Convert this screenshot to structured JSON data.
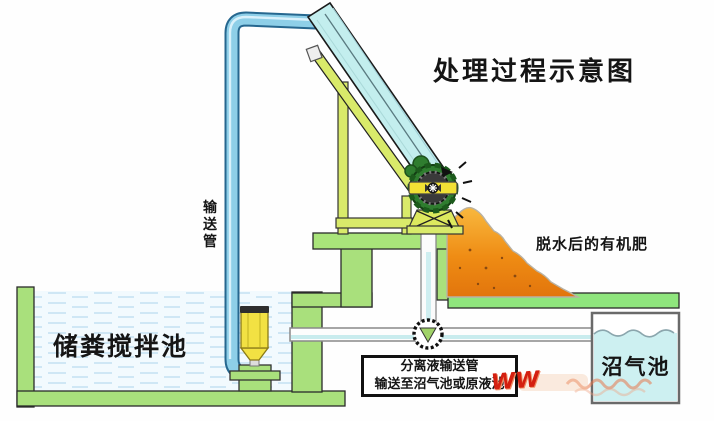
{
  "title": "处理过程示意图",
  "labels": {
    "conveying_pipe": "输送管",
    "storage_mixing_pool": "储粪搅拌池",
    "dewatered_fertilizer": "脱水后的有机肥",
    "biogas_pool": "沼气池"
  },
  "callout_box": {
    "line1": "分离液输送管",
    "line2": "输送至沼气池或原液池"
  },
  "watermark": "WW",
  "colors": {
    "wall_green": "#a9e07c",
    "floor_green": "#8fe57d",
    "frame_yellow_green": "#d9ea6a",
    "chute_cyan": "#c3eeee",
    "pipe_blue": "#8ecfe8",
    "pump_yellow": "#f2e143",
    "fertilizer_orange": "#ef8c14",
    "biogas_water": "#cdf0f1",
    "separator_dark_green": "#2f7d2f",
    "watermark_red": "#d41f10",
    "text_black": "#151515"
  }
}
